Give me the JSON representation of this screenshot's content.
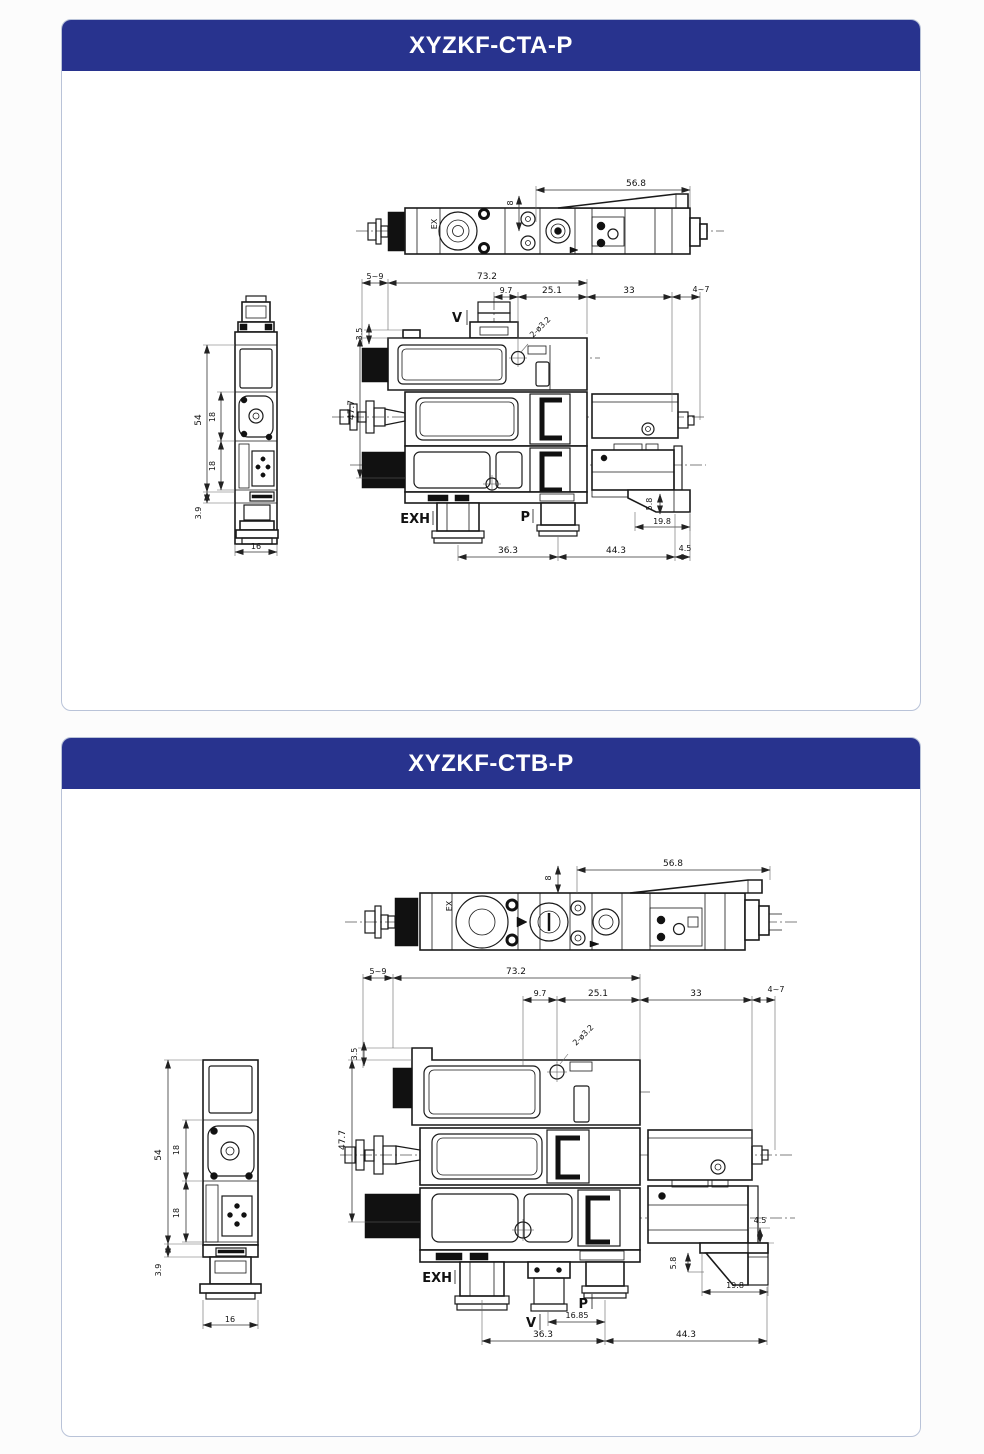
{
  "page": {
    "background": "#fcfcfc",
    "card_background": "#ffffff",
    "card_border_color": "#b9c3d8",
    "header_background": "#28338e",
    "header_text_color": "#ffffff",
    "line_color": "#1a1a1a"
  },
  "panels": [
    {
      "title": "XYZKF-CTA-P",
      "top_view": {
        "length_dim": "56.8",
        "offset_dim": "8",
        "label_ex": "EX"
      },
      "front_view": {
        "dim_left_protrusion": "5~9",
        "dim_body_width": "73.2",
        "dim_port_to_hole": "9.7",
        "dim_hole_to_edge": "25.1",
        "dim_right_block": "33",
        "dim_right_cap": "4~7",
        "dim_top_offset": "3.5",
        "dim_body_height": "47.7",
        "hole_label": "2-ø3.2",
        "port_v": "V",
        "port_exh": "EXH",
        "port_p": "P",
        "dim_exh_to_p": "36.3",
        "dim_p_to_end": "44.3",
        "dim_end_cap": "4.5",
        "dim_bracket_offset": "19.8",
        "dim_foot_height": "5.8"
      },
      "side_view": {
        "dim_height": "54",
        "dim_upper_seg": "18",
        "dim_lower_seg": "18",
        "dim_foot": "3.9",
        "dim_width": "16"
      }
    },
    {
      "title": "XYZKF-CTB-P",
      "top_view": {
        "length_dim": "56.8",
        "offset_dim": "8",
        "label_ex": "EX"
      },
      "front_view": {
        "dim_left_protrusion": "5~9",
        "dim_body_width": "73.2",
        "dim_port_to_hole": "9.7",
        "dim_hole_to_edge": "25.1",
        "dim_right_block": "33",
        "dim_right_cap": "4~7",
        "dim_top_offset": "3.5",
        "dim_body_height": "47.7",
        "hole_label": "2-ø3.2",
        "port_v": "V",
        "port_exh": "EXH",
        "port_p": "P",
        "dim_v_to_p": "16.85",
        "dim_exh_to_p": "36.3",
        "dim_p_to_end": "44.3",
        "dim_end_cap": "4.5",
        "dim_bracket_offset": "19.8",
        "dim_foot_height": "5.8"
      },
      "side_view": {
        "dim_height": "54",
        "dim_upper_seg": "18",
        "dim_lower_seg": "18",
        "dim_foot": "3.9",
        "dim_width": "16"
      }
    }
  ]
}
